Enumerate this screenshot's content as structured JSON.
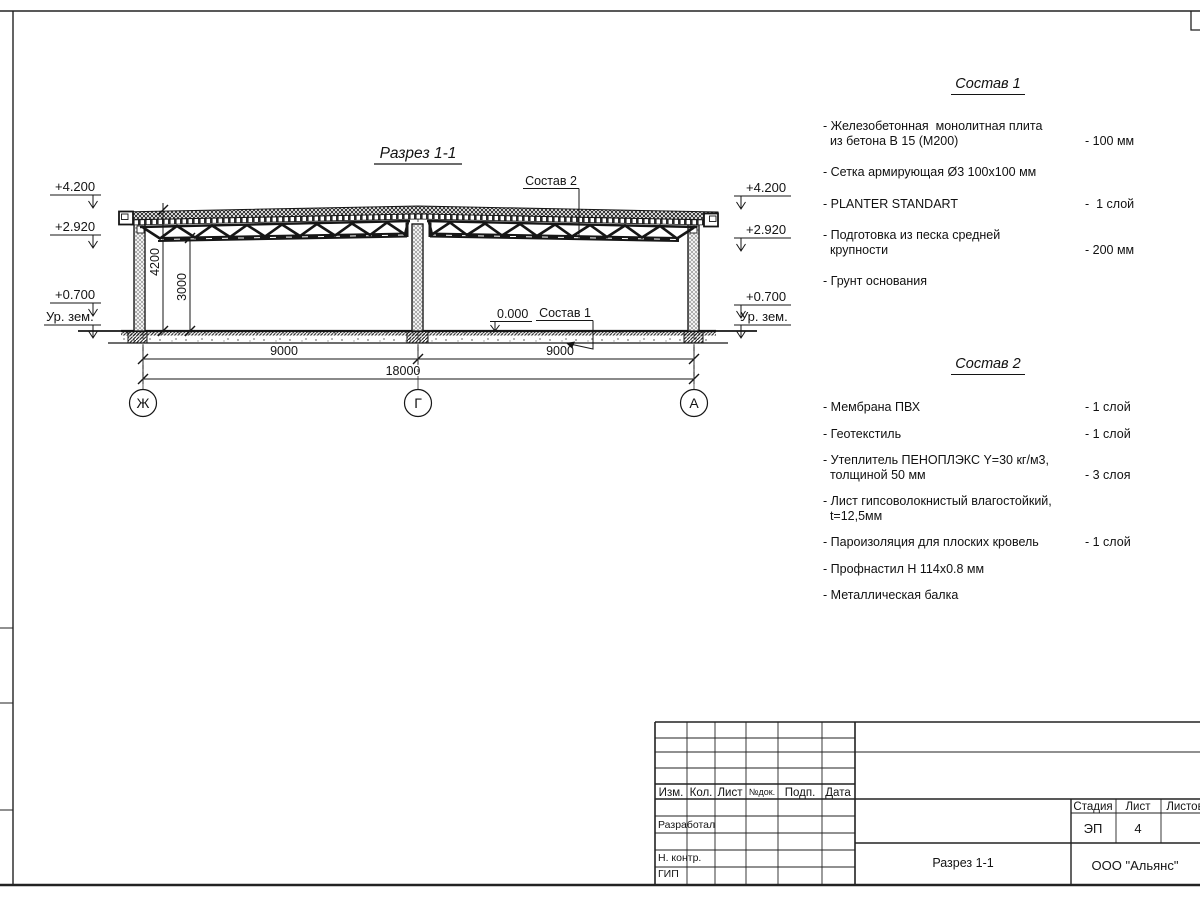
{
  "section": {
    "title": "Разрез 1-1",
    "elev_4200": "+4.200",
    "elev_2920": "+2.920",
    "elev_0700": "+0.700",
    "elev_ground": "Ур. зем.",
    "level_zero": "0.000",
    "dim_v1": "4200",
    "dim_v2": "3000",
    "dim_h1": "9000",
    "dim_h2": "9000",
    "dim_total": "18000",
    "axis_left": "Ж",
    "axis_mid": "Г",
    "axis_right": "А",
    "callout_1": "Состав 1",
    "callout_2": "Состав 2"
  },
  "lists": {
    "sostav1": {
      "title": "Состав 1",
      "items": [
        {
          "name": "- Железобетонная  монолитная плита\n  из бетона В 15 (М200)",
          "value": "- 100 мм"
        },
        {
          "name": "- Сетка армирующая Ø3 100х100 мм",
          "value": ""
        },
        {
          "name": "- PLANTER STANDART",
          "value": "-  1 слой"
        },
        {
          "name": "- Подготовка из песка средней\n  крупности",
          "value": "- 200 мм"
        },
        {
          "name": "- Грунт основания",
          "value": ""
        }
      ]
    },
    "sostav2": {
      "title": "Состав 2",
      "items": [
        {
          "name": "- Мембрана ПВХ",
          "value": "- 1 слой"
        },
        {
          "name": "- Геотекстиль",
          "value": "- 1 слой"
        },
        {
          "name": "- Утеплитель ПЕНОПЛЭКС Y=30 кг/м3,\n  толщиной 50 мм",
          "value": "- 3 слоя"
        },
        {
          "name": "- Лист гипсоволокнистый влагостойкий,\n  t=12,5мм",
          "value": ""
        },
        {
          "name": "- Пароизоляция для плоских кровель",
          "value": "- 1 слой"
        },
        {
          "name": "- Профнастил Н 114х0.8 мм",
          "value": ""
        },
        {
          "name": "- Металлическая балка",
          "value": ""
        }
      ]
    }
  },
  "titleblock": {
    "col_izm": "Изм.",
    "col_kol": "Кол.",
    "col_list": "Лист",
    "col_ndok": "№док.",
    "col_podp": "Подп.",
    "col_data": "Дата",
    "row_razrabotal": "Разработал",
    "row_nkontr": "Н. контр.",
    "row_gip": "ГИП",
    "stage_label": "Стадия",
    "sheet_label": "Лист",
    "sheets_label": "Листов",
    "stage_value": "ЭП",
    "sheet_value": "4",
    "doc_title": "Разрез 1-1",
    "company": "ООО \"Альянс\""
  }
}
